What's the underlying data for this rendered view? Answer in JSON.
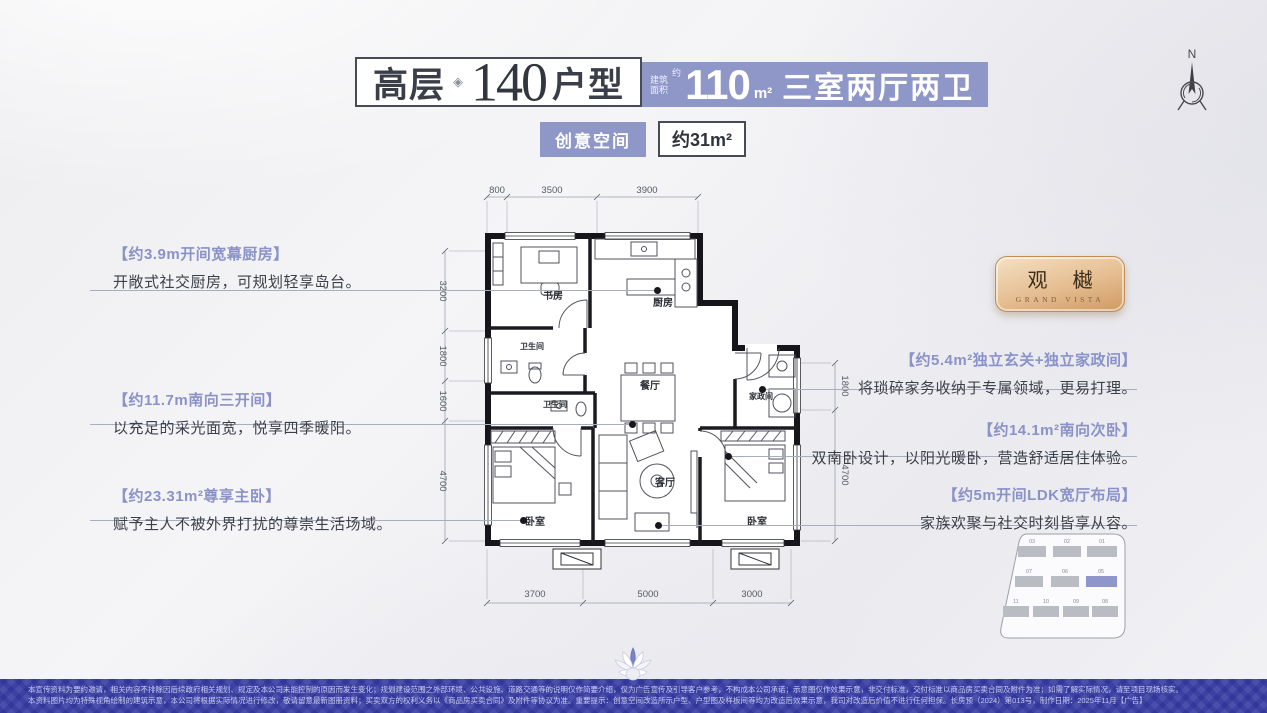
{
  "colors": {
    "accent_purple": "#8f97c8",
    "wall_black": "#15151a",
    "footer_blue": "#4a4fab",
    "logo_gold": "#e5bd90"
  },
  "header": {
    "type_label": "高层",
    "ornament": "◈",
    "type_number": "140",
    "type_suffix": "户型",
    "area_prefix_top": "建筑",
    "area_prefix_bottom": "面积",
    "area_approx": "约",
    "area_value": "110",
    "area_unit": "m²",
    "layout_text": "三室两厅两卫",
    "badge_creative": "创意空间",
    "badge_area": "约31m²"
  },
  "compass": {
    "label": "N"
  },
  "logo": {
    "name": "观 樾",
    "subtitle": "GRAND VISTA"
  },
  "callouts_left": [
    {
      "title": "【约3.9m开间宽幕厨房】",
      "body": "开敞式社交厨房，可规划轻享岛台。"
    },
    {
      "title": "【约11.7m南向三开间】",
      "body": "以充足的采光面宽，悦享四季暖阳。"
    },
    {
      "title": "【约23.31m²尊享主卧】",
      "body": "赋予主人不被外界打扰的尊崇生活场域。"
    }
  ],
  "callouts_right": [
    {
      "title": "【约5.4m²独立玄关+独立家政间】",
      "body": "将琐碎家务收纳于专属领域，更易打理。"
    },
    {
      "title": "【约14.1m²南向次卧】",
      "body": "双南卧设计，以阳光暖卧，营造舒适居住体验。"
    },
    {
      "title": "【约5m开间LDK宽厅布局】",
      "body": "家族欢聚与社交时刻皆享从容。"
    }
  ],
  "floorplan": {
    "rooms": {
      "study": "书房",
      "kitchen": "厨房",
      "bath1": "卫生间",
      "bath2": "卫生间",
      "dining": "餐厅",
      "laundry": "家政间",
      "bed_master": "卧室",
      "living": "客厅",
      "bed_second": "卧室"
    },
    "dims_top": [
      "800",
      "3500",
      "3900"
    ],
    "dims_left": [
      "3200",
      "1800",
      "1600",
      "4700"
    ],
    "dims_right": [
      "1800",
      "4700"
    ],
    "dims_bottom": [
      "3700",
      "5000",
      "3000"
    ]
  },
  "siteplan": {
    "rows": [
      [
        "03",
        "02",
        "01"
      ],
      [
        "07",
        "06",
        "05"
      ],
      [
        "11",
        "10",
        "09",
        "08"
      ]
    ],
    "highlighted": "05"
  },
  "footer": {
    "line1": "本宣传资料为要约邀请，相关内容不排除因后续政府相关规划、规定及本公司未能控制的原因而发生变化；规划建设范围之外部环境、公共设施、道路交通等的说明仅作简要介绍，仅为广告宣传及引导客户参考，不构成本公司承诺；示意图仅作效果示意，非交付标准，交付标准以商品房买卖合同及附件为准；如需了解实际情况，请至项目现场核实。",
    "line2": "本资料图片均为特殊视角绘制的建筑示意，本公司将根据实际情况进行修改，敬请留意最新图册资料；买卖双方的权利义务以《商品房买卖合同》及附件等协议为准。重要提示：创意空间改造所示户型、户型图及样板间等均为改造后效果示意，我司对改造后价值不进行任何担保。长房预（2024）第013号，制作日期：2025年11月【广告】"
  }
}
